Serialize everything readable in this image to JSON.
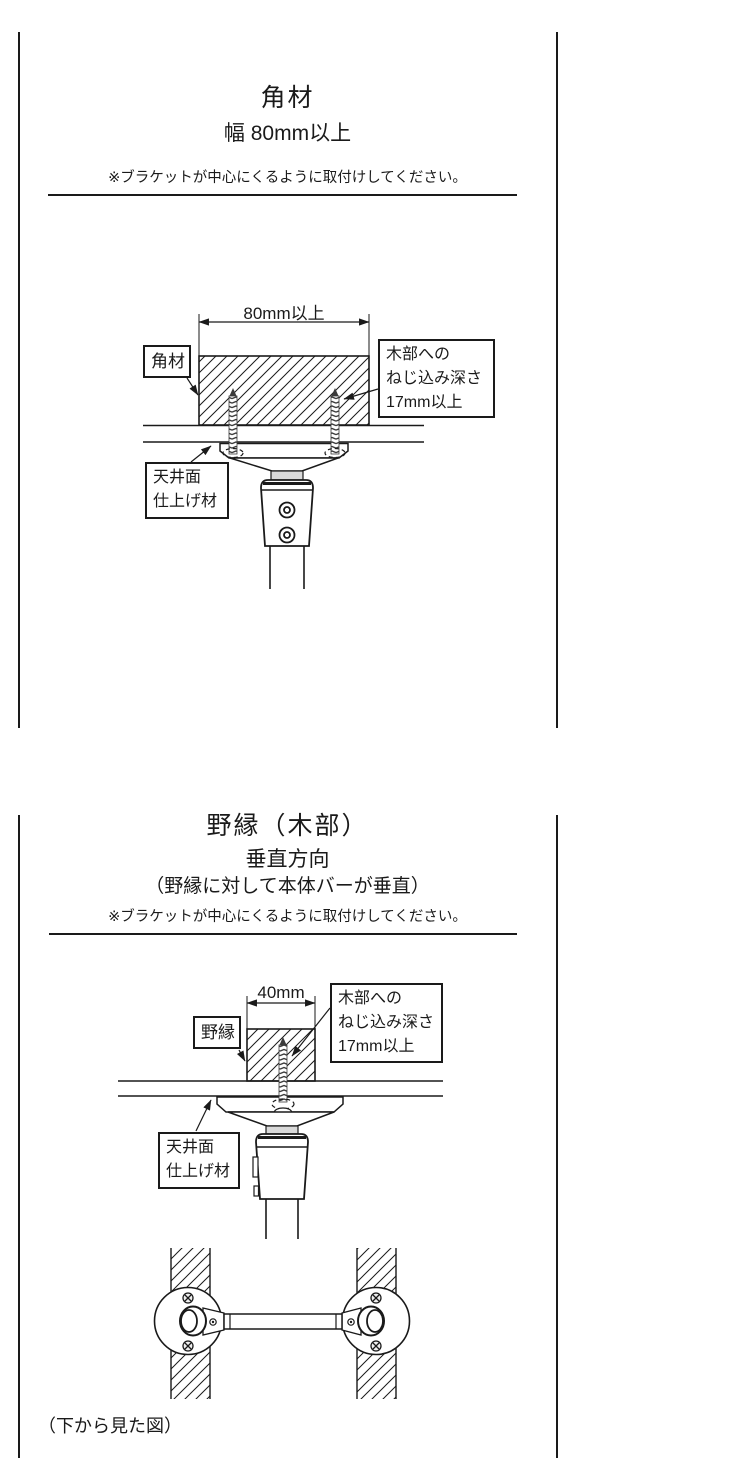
{
  "colors": {
    "line": "#1a1a1a",
    "neck_gray": "#d9d9d9",
    "bg": "#ffffff"
  },
  "panel_kakuzai": {
    "title": "角材",
    "subtitle": "幅 80mm以上",
    "note": "※ブラケットが中心にくるように取付けしてください。",
    "dimension": "80mm以上",
    "labels": {
      "part": "角材",
      "screw_depth": [
        "木部への",
        "ねじ込み深さ",
        "17mm以上"
      ],
      "ceiling": [
        "天井面",
        "仕上げ材"
      ]
    }
  },
  "panel_nobuchi": {
    "title": "野縁（木部）",
    "subtitle": "垂直方向",
    "subtitle_detail": "（野縁に対して本体バーが垂直）",
    "note": "※ブラケットが中心にくるように取付けしてください。",
    "dimension": "40mm",
    "labels": {
      "part": "野縁",
      "screw_depth": [
        "木部への",
        "ねじ込み深さ",
        "17mm以上"
      ],
      "ceiling": [
        "天井面",
        "仕上げ材"
      ]
    },
    "bottom_view_caption": "（下から見た図）"
  }
}
